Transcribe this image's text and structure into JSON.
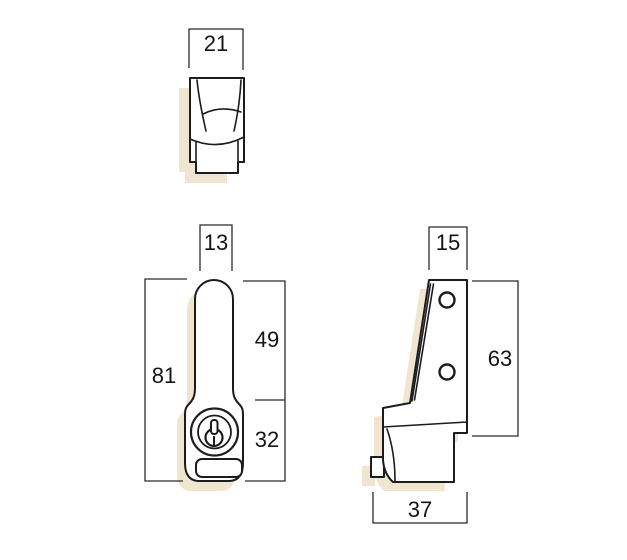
{
  "dimensions": {
    "top_width": "21",
    "front_handle_width": "13",
    "front_total_height": "81",
    "front_upper_height": "49",
    "front_lower_height": "32",
    "side_top_width": "15",
    "side_height": "63",
    "side_base_width": "37"
  },
  "colors": {
    "background": "#ffffff",
    "outline": "#1c1c1e",
    "dimension_line": "#2b2b2b",
    "label_text": "#141416",
    "shadow": "#f0e6cf",
    "part_fill": "#ffffff"
  }
}
